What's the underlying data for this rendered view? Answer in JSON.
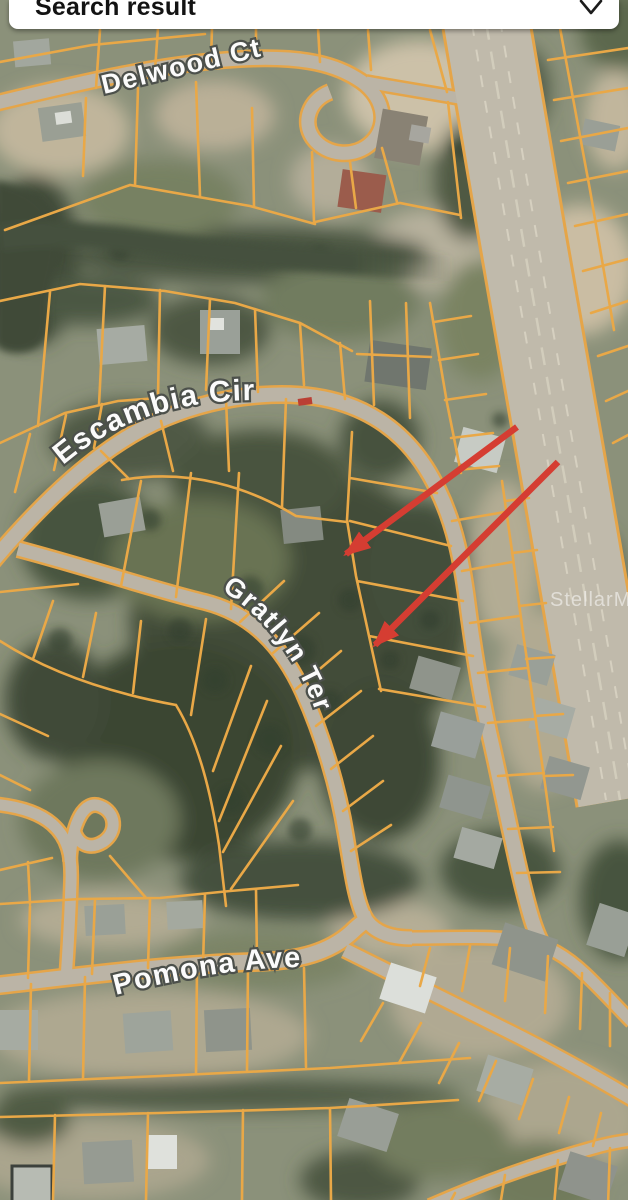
{
  "header": {
    "title": "Search result",
    "icon": "chevron-down"
  },
  "map": {
    "type": "satellite-parcel-view",
    "watermark": "StellarMLS",
    "streets": [
      {
        "id": "delwood",
        "label": "Delwood Ct"
      },
      {
        "id": "escambia",
        "label": "Escambia Cir"
      },
      {
        "id": "gratlyn",
        "label": "Gratlyn Ter"
      },
      {
        "id": "pomona",
        "label": "Pomona Ave"
      }
    ],
    "annotations": {
      "arrows": [
        {
          "from": {
            "x": 517,
            "y": 427
          },
          "to": {
            "x": 346,
            "y": 554
          },
          "color": "#e2382c"
        },
        {
          "from": {
            "x": 558,
            "y": 462
          },
          "to": {
            "x": 375,
            "y": 645
          },
          "color": "#e2382c"
        }
      ]
    },
    "colors": {
      "parcel_line": "#f2a93c",
      "road": "#bdb6a6",
      "highway": "#c3bcab",
      "arrow": "#e2382c",
      "label_fill": "#ffffff",
      "label_outline": "#4a4f49"
    }
  }
}
